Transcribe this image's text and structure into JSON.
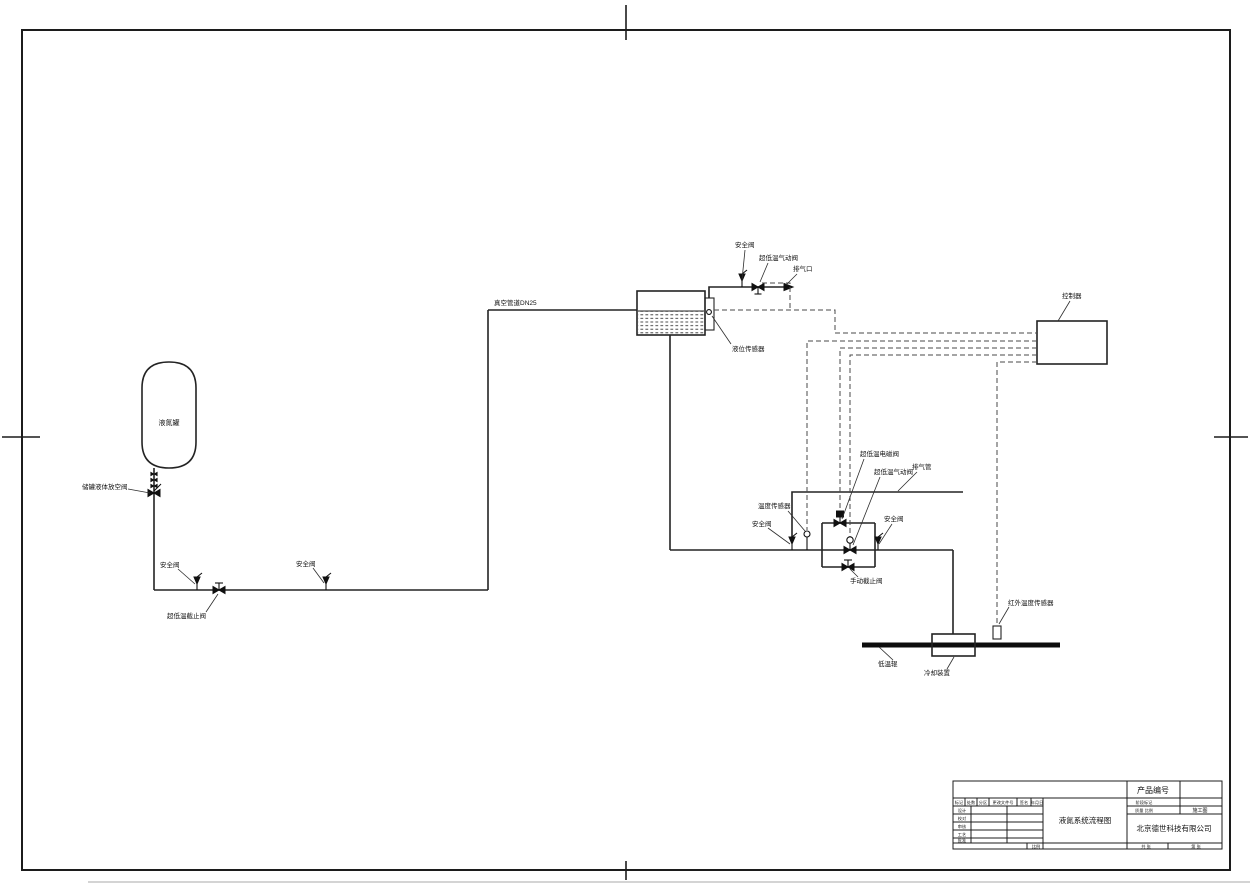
{
  "labels": {
    "tank": "液氮罐",
    "tank_outlet_valve": "储罐液体放空阀",
    "safety_valve": "安全阀",
    "cryo_stop_valve": "超低温截止阀",
    "vacuum_pipe": "真空管道DN25",
    "level_sensor": "液位传感器",
    "cryo_pneumatic_valve": "超低温气动阀",
    "vent_port": "排气口",
    "controller": "控制器",
    "cryo_solenoid_valve": "超低温电磁阀",
    "vent_pipe": "排气管",
    "temp_sensor": "温度传感器",
    "manual_stop_valve": "手动截止阀",
    "cryo_roller": "低温辊",
    "cooling_device": "冷却装置",
    "ir_temp_sensor": "红外温度传感器"
  },
  "titleblock": {
    "product_no": "产品编号",
    "drawing_title": "液氮系统流程图",
    "company": "北京德世科技有限公司",
    "stage_value": "施工图",
    "stage_label": "阶段标记",
    "weight_scale": "质量 比例",
    "fields": {
      "mark": "标记",
      "count": "处数",
      "zone": "分区",
      "change_doc": "更改文件号",
      "sign": "签名",
      "date": "年月日",
      "design": "设计",
      "proof": "校对",
      "audit": "审核",
      "process": "工艺",
      "approve": "批准",
      "scale": "比例",
      "sheet_total": "共 张",
      "sheet_no": "第 张"
    }
  },
  "colors": {
    "ink": "#1f1f1f",
    "paper": "#ffffff"
  }
}
